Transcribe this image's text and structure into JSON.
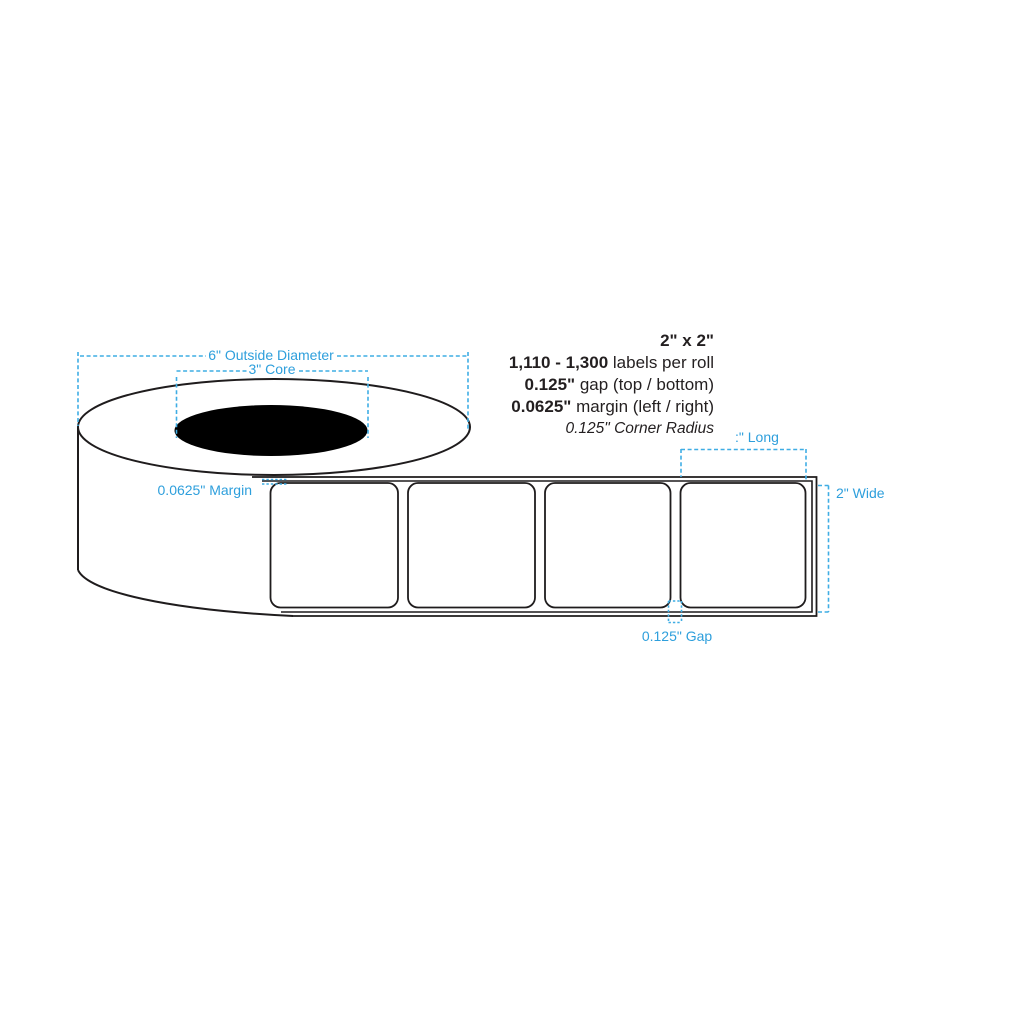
{
  "diagram": {
    "title_context": "label roll specification diagram",
    "roll": {
      "outside_diameter_label": "6\" Outside Diameter",
      "core_label": "3\" Core",
      "margin_label": "0.0625\" Margin"
    },
    "strip": {
      "long_label": ":\" Long",
      "wide_label": "2\" Wide",
      "gap_label": "0.125\" Gap",
      "blank_labels_visible": 4
    },
    "specs": {
      "size": "2\" x 2\"",
      "labels_per_roll_value": "1,110 - 1,300",
      "labels_per_roll_text": " labels per roll",
      "gap_value": "0.125\"",
      "gap_text": " gap (top / bottom)",
      "margin_value": "0.0625\"",
      "margin_text": " margin (left / right)",
      "corner_radius": "0.125\" Corner Radius"
    },
    "colors": {
      "annotation_blue": "#2E9FDC",
      "dashed_line_blue": "#3FADE4",
      "outline_black": "#1F1C1D",
      "core_fill": "#000000",
      "background": "#FFFFFF"
    }
  }
}
